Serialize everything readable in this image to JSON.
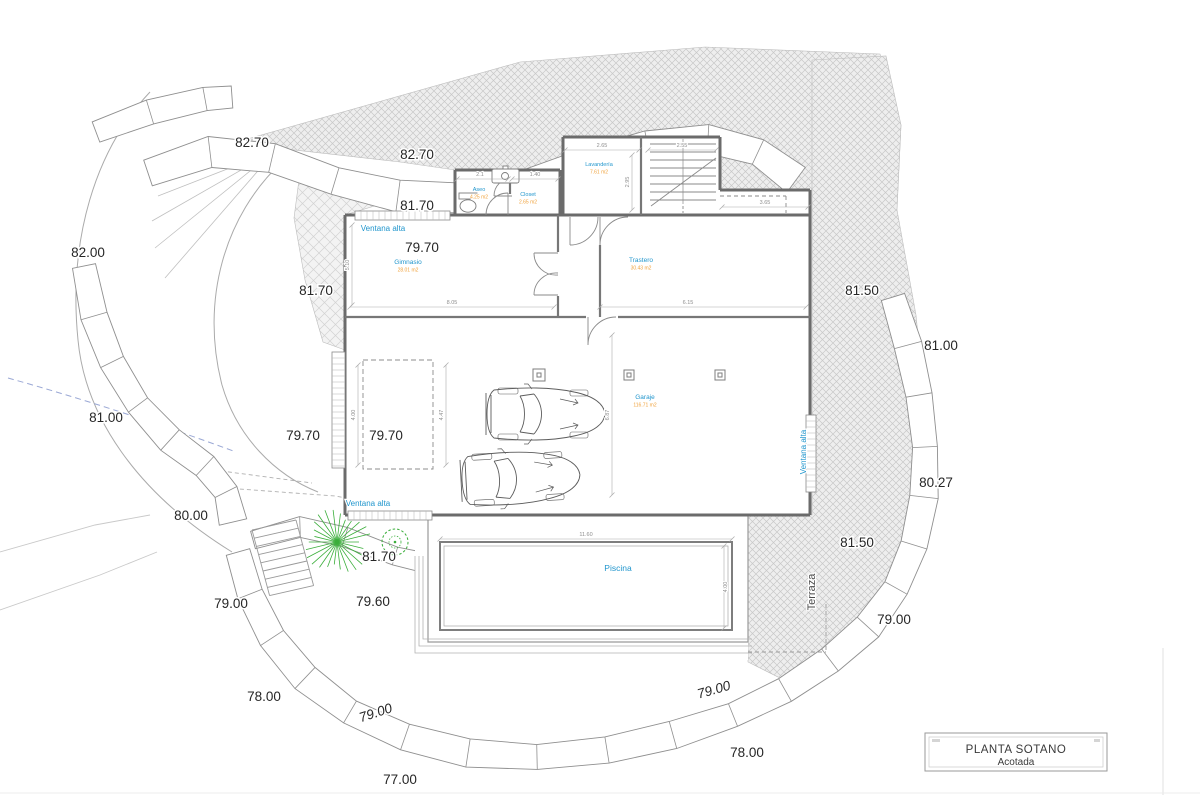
{
  "drawing": {
    "colors": {
      "label_blue": "#2196cd",
      "area_orange": "#f0a23c",
      "plant_green": "#3aae3a",
      "wall_gray": "#6b6b6b",
      "hatch_gray": "#c8c8c8",
      "dim_gray": "#8f8f8f",
      "text_black": "#262626"
    },
    "title_block": {
      "title": "PLANTA SOTANO",
      "subtitle": "Acotada"
    },
    "rooms": [
      {
        "name": "Aseo",
        "area": "4.25 m2",
        "x": 479,
        "y": 191,
        "size": 5.5
      },
      {
        "name": "Closet",
        "area": "2.65 m2",
        "x": 528,
        "y": 196,
        "size": 5.5
      },
      {
        "name": "Lavandería",
        "area": "7.61 m2",
        "x": 599,
        "y": 166,
        "size": 5.5
      },
      {
        "name": "Gimnasio",
        "area": "28.01 m2",
        "x": 408,
        "y": 264,
        "size": 6.5
      },
      {
        "name": "Trastero",
        "area": "30.43 m2",
        "x": 641,
        "y": 262,
        "size": 6.5
      },
      {
        "name": "Garaje",
        "area": "116.71 m2",
        "x": 645,
        "y": 399,
        "size": 6.5
      },
      {
        "name": "Piscina",
        "area": "",
        "x": 618,
        "y": 571,
        "size": 8.5
      }
    ],
    "annotations": {
      "ventana_alta": {
        "label": "Ventana alta",
        "positions": [
          {
            "x": 383,
            "y": 231,
            "rot": 0
          },
          {
            "x": 368,
            "y": 506,
            "rot": 0
          },
          {
            "x": 806,
            "y": 452,
            "rot": -90
          }
        ]
      },
      "terraza": {
        "label": "Terraza",
        "x": 815,
        "y": 592,
        "rot": -90
      }
    },
    "elevations": [
      {
        "value": "82.70",
        "x": 252,
        "y": 147,
        "rot": 0,
        "italic": false
      },
      {
        "value": "82.70",
        "x": 417,
        "y": 159,
        "rot": 0,
        "italic": false
      },
      {
        "value": "82.00",
        "x": 88,
        "y": 257,
        "rot": 0,
        "italic": false
      },
      {
        "value": "81.70",
        "x": 417,
        "y": 210,
        "rot": 0,
        "italic": false
      },
      {
        "value": "81.70",
        "x": 316,
        "y": 295,
        "rot": 0,
        "italic": false
      },
      {
        "value": "79.70",
        "x": 422,
        "y": 252,
        "rot": 0,
        "italic": false
      },
      {
        "value": "81.50",
        "x": 862,
        "y": 295,
        "rot": 0,
        "italic": false
      },
      {
        "value": "81.00",
        "x": 941,
        "y": 350,
        "rot": 0,
        "italic": false
      },
      {
        "value": "81.00",
        "x": 106,
        "y": 422,
        "rot": 0,
        "italic": false
      },
      {
        "value": "79.70",
        "x": 303,
        "y": 440,
        "rot": 0,
        "italic": false
      },
      {
        "value": "79.70",
        "x": 386,
        "y": 440,
        "rot": 0,
        "italic": false
      },
      {
        "value": "80.27",
        "x": 936,
        "y": 487,
        "rot": 0,
        "italic": false
      },
      {
        "value": "80.00",
        "x": 191,
        "y": 520,
        "rot": 0,
        "italic": false
      },
      {
        "value": "81.50",
        "x": 857,
        "y": 547,
        "rot": 0,
        "italic": false
      },
      {
        "value": "81.70",
        "x": 379,
        "y": 561,
        "rot": 0,
        "italic": false
      },
      {
        "value": "79.60",
        "x": 373,
        "y": 606,
        "rot": 0,
        "italic": false
      },
      {
        "value": "79.00",
        "x": 231,
        "y": 608,
        "rot": 0,
        "italic": false
      },
      {
        "value": "79.00",
        "x": 894,
        "y": 624,
        "rot": 0,
        "italic": false
      },
      {
        "value": "79.00",
        "x": 715,
        "y": 694,
        "rot": -16,
        "italic": true
      },
      {
        "value": "78.00",
        "x": 264,
        "y": 701,
        "rot": 0,
        "italic": false
      },
      {
        "value": "79.00",
        "x": 377,
        "y": 717,
        "rot": -18,
        "italic": true
      },
      {
        "value": "78.00",
        "x": 747,
        "y": 757,
        "rot": 0,
        "italic": false
      },
      {
        "value": "77.00",
        "x": 400,
        "y": 784,
        "rot": 0,
        "italic": false
      }
    ],
    "dimensions": [
      {
        "value": "2.65",
        "x": 602,
        "y": 147,
        "rot": 0
      },
      {
        "value": "2.55",
        "x": 682,
        "y": 147,
        "rot": 0
      },
      {
        "value": "2.95",
        "x": 629,
        "y": 182,
        "rot": -90
      },
      {
        "value": "2.1",
        "x": 480,
        "y": 176,
        "rot": 0
      },
      {
        "value": "1.40",
        "x": 535,
        "y": 176,
        "rot": 0
      },
      {
        "value": "8.05",
        "x": 452,
        "y": 304,
        "rot": 0
      },
      {
        "value": "6.15",
        "x": 688,
        "y": 304,
        "rot": 0
      },
      {
        "value": "3.65",
        "x": 765,
        "y": 204,
        "rot": 0
      },
      {
        "value": "5.10",
        "x": 349,
        "y": 265,
        "rot": -90
      },
      {
        "value": "4.00",
        "x": 355,
        "y": 415,
        "rot": -90
      },
      {
        "value": "4.47",
        "x": 443,
        "y": 415,
        "rot": -90
      },
      {
        "value": "6.87",
        "x": 609,
        "y": 415,
        "rot": -90
      },
      {
        "value": "11.60",
        "x": 586,
        "y": 536,
        "rot": 0
      },
      {
        "value": "4.00",
        "x": 727,
        "y": 587,
        "rot": -90
      }
    ]
  }
}
